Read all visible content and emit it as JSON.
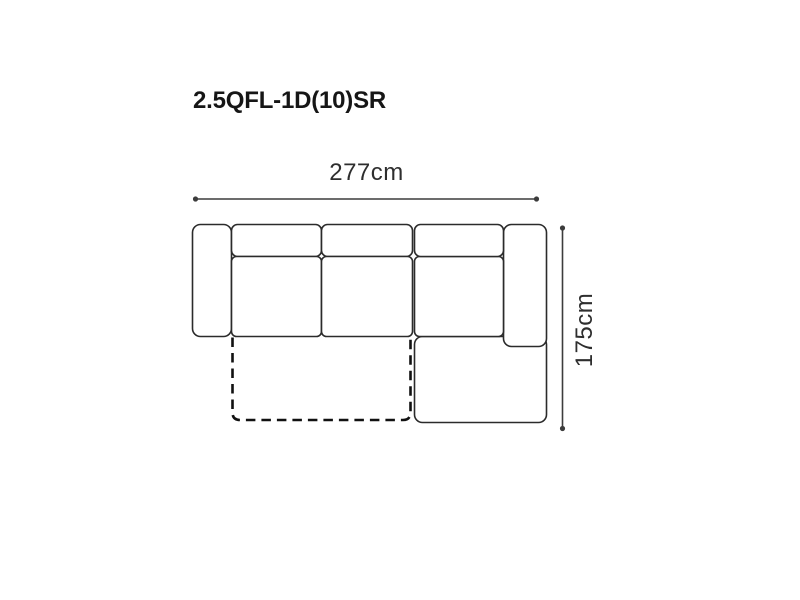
{
  "title": {
    "text": "2.5QFL-1D(10)SR"
  },
  "diagram": {
    "type": "sofa-top-view-dimension-diagram",
    "width": {
      "label": "277cm",
      "value_cm": 277,
      "orientation": "horizontal"
    },
    "depth": {
      "label": "175cm",
      "value_cm": 175,
      "orientation": "vertical"
    },
    "parts": [
      "left-armrest",
      "back-cushion-1",
      "back-cushion-2",
      "back-cushion-3",
      "seat-cushion-1",
      "seat-cushion-2",
      "chaise-seat",
      "chaise-extension",
      "right-armrest",
      "fold-out-outline-dashed"
    ]
  },
  "colors": {
    "bg": "#ffffff",
    "line": "#2b2b2b",
    "dim": "#3c3c3c",
    "dash": "#111111",
    "text": "#2e2e2e",
    "title": "#161616"
  }
}
